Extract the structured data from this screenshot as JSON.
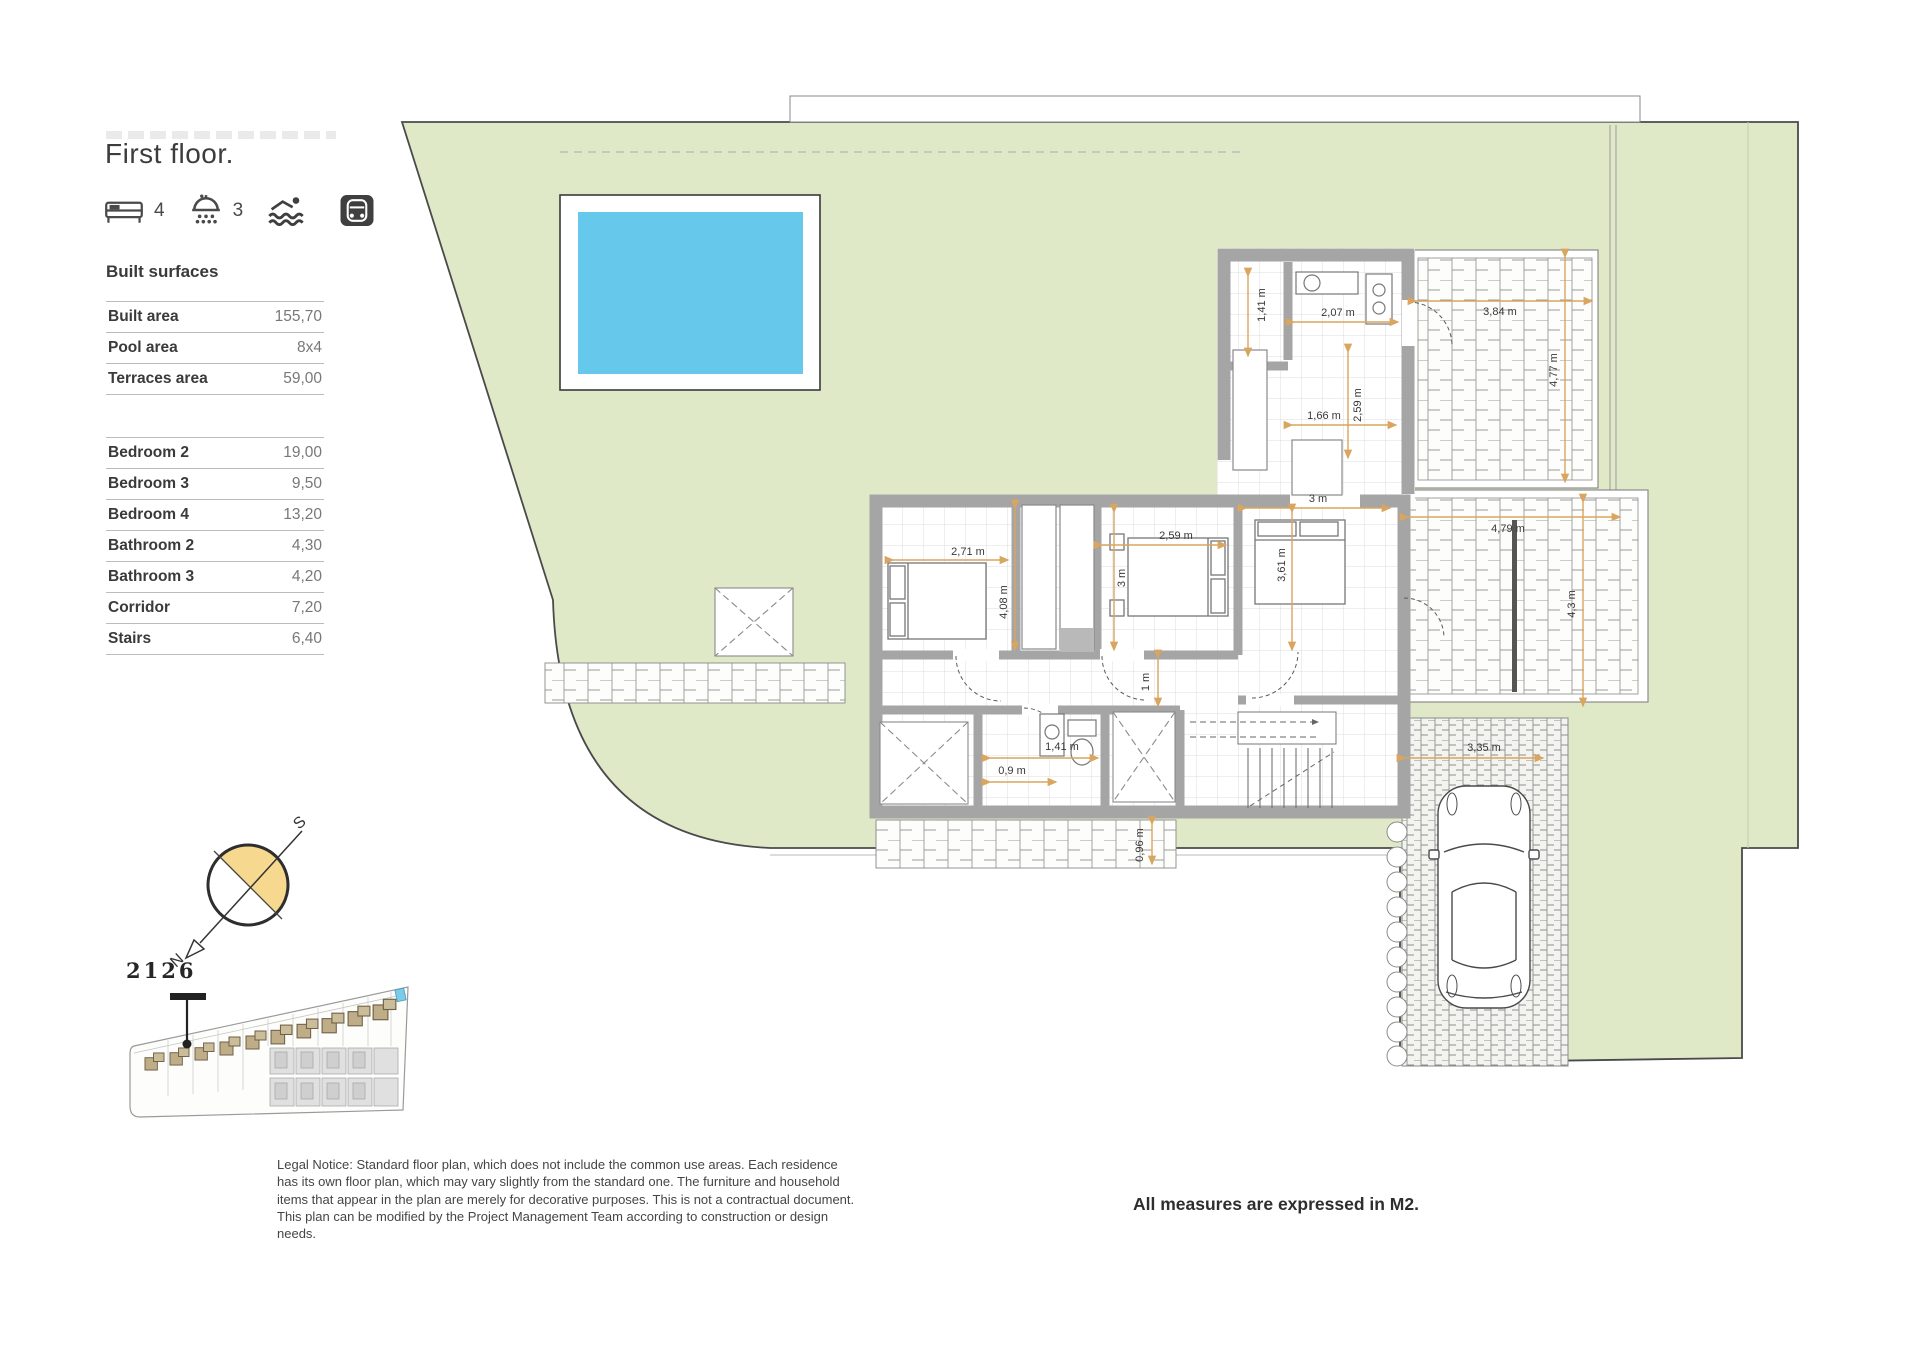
{
  "header": {
    "title": "First floor.",
    "features": {
      "bedrooms": "4",
      "bathrooms": "3"
    }
  },
  "built_surfaces": {
    "heading": "Built surfaces",
    "rows": [
      {
        "label": "Built area",
        "value": "155,70"
      },
      {
        "label": "Pool area",
        "value": "8x4"
      },
      {
        "label": "Terraces area",
        "value": "59,00"
      }
    ]
  },
  "room_surfaces": {
    "rows": [
      {
        "label": "Bedroom 2",
        "value": "19,00"
      },
      {
        "label": "Bedroom 3",
        "value": "9,50"
      },
      {
        "label": "Bedroom 4",
        "value": "13,20"
      },
      {
        "label": "Bathroom 2",
        "value": "4,30"
      },
      {
        "label": "Bathroom 3",
        "value": "4,20"
      },
      {
        "label": "Corridor",
        "value": "7,20"
      },
      {
        "label": "Stairs",
        "value": "6,40"
      }
    ]
  },
  "compass": {
    "north": "N",
    "south": "S"
  },
  "site": {
    "unit_number": "2126"
  },
  "notes": {
    "legal": "Legal Notice: Standard floor plan, which does not include the common use areas. Each residence has its own floor plan, which may vary slightly from the standard one. The furniture and household items that appear in the plan are merely for decorative purposes. This is not a contractual document. This plan can be modified by the Project Management Team according to construction or design needs.",
    "measures": "All measures are expressed in M2."
  },
  "plan": {
    "dimensions": [
      {
        "label": "1,41 m",
        "x": 1262,
        "y": 305,
        "rot": true
      },
      {
        "label": "2,07 m",
        "x": 1338,
        "y": 313,
        "rot": false
      },
      {
        "label": "1,66 m",
        "x": 1324,
        "y": 416,
        "rot": false
      },
      {
        "label": "2,59 m",
        "x": 1358,
        "y": 405,
        "rot": true
      },
      {
        "label": "3,84 m",
        "x": 1500,
        "y": 312,
        "rot": false
      },
      {
        "label": "4,77 m",
        "x": 1554,
        "y": 370,
        "rot": true
      },
      {
        "label": "3 m",
        "x": 1318,
        "y": 499,
        "rot": false
      },
      {
        "label": "2,71 m",
        "x": 968,
        "y": 552,
        "rot": false
      },
      {
        "label": "2,59 m",
        "x": 1176,
        "y": 536,
        "rot": false
      },
      {
        "label": "3,61 m",
        "x": 1282,
        "y": 565,
        "rot": true
      },
      {
        "label": "3 m",
        "x": 1122,
        "y": 578,
        "rot": true
      },
      {
        "label": "4,08 m",
        "x": 1004,
        "y": 602,
        "rot": true
      },
      {
        "label": "1 m",
        "x": 1146,
        "y": 682,
        "rot": true
      },
      {
        "label": "1,41 m",
        "x": 1062,
        "y": 747,
        "rot": false
      },
      {
        "label": "0,9 m",
        "x": 1012,
        "y": 771,
        "rot": false
      },
      {
        "label": "0,96 m",
        "x": 1140,
        "y": 845,
        "rot": true
      },
      {
        "label": "4,79 m",
        "x": 1508,
        "y": 529,
        "rot": false
      },
      {
        "label": "4,3 m",
        "x": 1572,
        "y": 604,
        "rot": true
      },
      {
        "label": "3,35 m",
        "x": 1484,
        "y": 748,
        "rot": false
      }
    ]
  },
  "colors": {
    "lawn": "#dfe9c8",
    "pool_water": "#66c9eb",
    "walls": "#a5a5a5",
    "dimension_accent": "#d9a55f",
    "compass_yellow": "#f6d88e",
    "site_house_tan": "#bfad88"
  }
}
